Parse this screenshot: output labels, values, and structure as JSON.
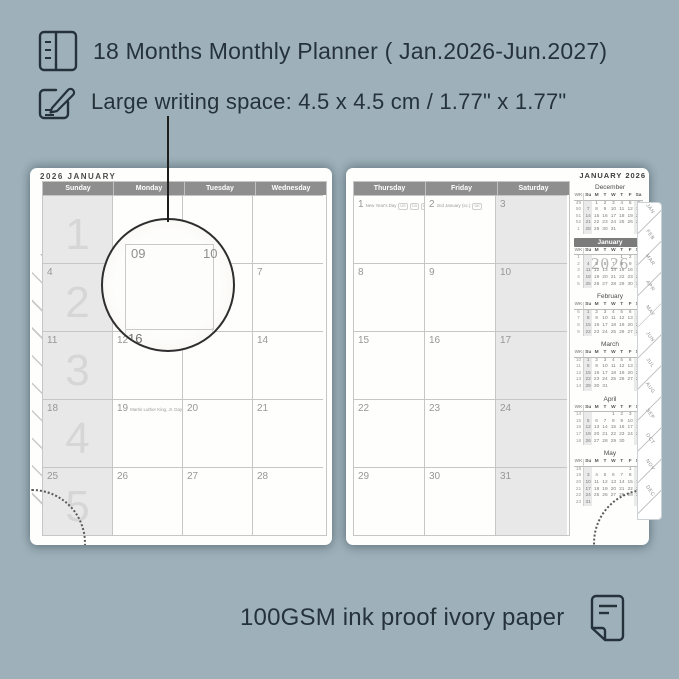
{
  "header": {
    "line1": "18 Months Monthly Planner ( Jan.2026-Jun.2027)",
    "line2": "Large writing space: 4.5 x 4.5 cm / 1.77\" x 1.77\""
  },
  "footer": {
    "text": "100GSM ink proof ivory paper"
  },
  "icons": {
    "feature1": "planner-book-icon",
    "feature2": "pencil-note-icon",
    "footer": "paper-icon"
  },
  "colors": {
    "background": "#9EB1BA",
    "ink": "#25323B",
    "page": "#FEFEFD",
    "header_bar": "#8E8E8E",
    "shaded_cell": "#E8E8E8",
    "grid_line": "#C6C6C6",
    "date_text": "#979797",
    "week_number_text": "#D6D6D6",
    "mini_highlight_bar": "#7B7B7B"
  },
  "left_page": {
    "title": "2026 JANUARY",
    "day_headers": [
      "Sunday",
      "Monday",
      "Tuesday",
      "Wednesday"
    ],
    "weeks": [
      {
        "num": "1",
        "dates": [
          "",
          "",
          "",
          ""
        ]
      },
      {
        "num": "2",
        "dates": [
          "4",
          "5",
          "6",
          "7"
        ]
      },
      {
        "num": "3",
        "dates": [
          "11",
          "12",
          "13",
          "14"
        ]
      },
      {
        "num": "4",
        "dates": [
          "18",
          "19",
          "20",
          "21"
        ],
        "notes": {
          "1": {
            "label": "Martin Luther King, Jr. Day",
            "badges": [
              "US"
            ]
          }
        }
      },
      {
        "num": "5",
        "dates": [
          "25",
          "26",
          "27",
          "28"
        ]
      }
    ]
  },
  "right_page": {
    "day_headers": [
      "Thursday",
      "Friday",
      "Saturday"
    ],
    "weeks": [
      {
        "dates": [
          "1",
          "2",
          "3"
        ],
        "notes": {
          "0": {
            "label": "New Year's Day",
            "badges": [
              "US",
              "CA",
              "UK",
              "AU",
              "NZ"
            ]
          },
          "1": {
            "label": "2nd January (sc.)",
            "badges": [
              "UK"
            ]
          }
        }
      },
      {
        "dates": [
          "8",
          "9",
          "10"
        ]
      },
      {
        "dates": [
          "15",
          "16",
          "17"
        ]
      },
      {
        "dates": [
          "22",
          "23",
          "24"
        ]
      },
      {
        "dates": [
          "29",
          "30",
          "31"
        ]
      }
    ]
  },
  "sidebar": {
    "title": "JANUARY 2026",
    "dow": [
      "WK",
      "Su",
      "M",
      "T",
      "W",
      "T",
      "F",
      "Sa"
    ],
    "months": [
      {
        "name": "December",
        "highlight": false,
        "watermark": "",
        "rows": [
          [
            "49",
            "",
            "1",
            "2",
            "3",
            "4",
            "5",
            "6"
          ],
          [
            "50",
            "7",
            "8",
            "9",
            "10",
            "11",
            "12",
            "13"
          ],
          [
            "51",
            "14",
            "15",
            "16",
            "17",
            "18",
            "19",
            "20"
          ],
          [
            "52",
            "21",
            "22",
            "23",
            "24",
            "25",
            "26",
            "27"
          ],
          [
            "1",
            "28",
            "29",
            "30",
            "31",
            "",
            "",
            ""
          ]
        ]
      },
      {
        "name": "January",
        "highlight": true,
        "watermark": "2026",
        "rows": [
          [
            "1",
            "",
            "",
            "",
            "",
            "1",
            "2",
            "3"
          ],
          [
            "2",
            "4",
            "5",
            "6",
            "7",
            "8",
            "9",
            "10"
          ],
          [
            "3",
            "11",
            "12",
            "13",
            "14",
            "15",
            "16",
            "17"
          ],
          [
            "4",
            "18",
            "19",
            "20",
            "21",
            "22",
            "23",
            "24"
          ],
          [
            "5",
            "25",
            "26",
            "27",
            "28",
            "29",
            "30",
            "31"
          ]
        ]
      },
      {
        "name": "February",
        "highlight": false,
        "watermark": "",
        "rows": [
          [
            "6",
            "1",
            "2",
            "3",
            "4",
            "5",
            "6",
            "7"
          ],
          [
            "7",
            "8",
            "9",
            "10",
            "11",
            "12",
            "13",
            "14"
          ],
          [
            "8",
            "15",
            "16",
            "17",
            "18",
            "19",
            "20",
            "21"
          ],
          [
            "9",
            "22",
            "23",
            "24",
            "25",
            "26",
            "27",
            "28"
          ]
        ]
      },
      {
        "name": "March",
        "highlight": false,
        "watermark": "",
        "rows": [
          [
            "10",
            "1",
            "2",
            "3",
            "4",
            "5",
            "6",
            "7"
          ],
          [
            "11",
            "8",
            "9",
            "10",
            "11",
            "12",
            "13",
            "14"
          ],
          [
            "12",
            "15",
            "16",
            "17",
            "18",
            "19",
            "20",
            "21"
          ],
          [
            "13",
            "22",
            "23",
            "24",
            "25",
            "26",
            "27",
            "28"
          ],
          [
            "14",
            "29",
            "30",
            "31",
            "",
            "",
            "",
            ""
          ]
        ]
      },
      {
        "name": "April",
        "highlight": false,
        "watermark": "",
        "rows": [
          [
            "14",
            "",
            "",
            "",
            "1",
            "2",
            "3",
            "4"
          ],
          [
            "15",
            "5",
            "6",
            "7",
            "8",
            "9",
            "10",
            "11"
          ],
          [
            "16",
            "12",
            "13",
            "14",
            "15",
            "16",
            "17",
            "18"
          ],
          [
            "17",
            "19",
            "20",
            "21",
            "22",
            "23",
            "24",
            "25"
          ],
          [
            "18",
            "26",
            "27",
            "28",
            "29",
            "30",
            "",
            ""
          ]
        ]
      },
      {
        "name": "May",
        "highlight": false,
        "watermark": "",
        "rows": [
          [
            "18",
            "",
            "",
            "",
            "",
            "",
            "1",
            "2"
          ],
          [
            "19",
            "3",
            "4",
            "5",
            "6",
            "7",
            "8",
            "9"
          ],
          [
            "20",
            "10",
            "11",
            "12",
            "13",
            "14",
            "15",
            "16"
          ],
          [
            "21",
            "17",
            "18",
            "19",
            "20",
            "21",
            "22",
            "23"
          ],
          [
            "22",
            "24",
            "25",
            "26",
            "27",
            "28",
            "29",
            "30"
          ],
          [
            "23",
            "31",
            "",
            "",
            "",
            "",
            "",
            ""
          ]
        ]
      }
    ]
  },
  "tabs": [
    "JAN",
    "FEB",
    "MAR",
    "APR",
    "MAY",
    "JUN",
    "JUL",
    "AUG",
    "SEP",
    "OCT",
    "NOV",
    "DEC"
  ],
  "magnifier": {
    "magnified_date": "09",
    "neighbor_right_date": "10",
    "neighbor_below_date": "16"
  }
}
